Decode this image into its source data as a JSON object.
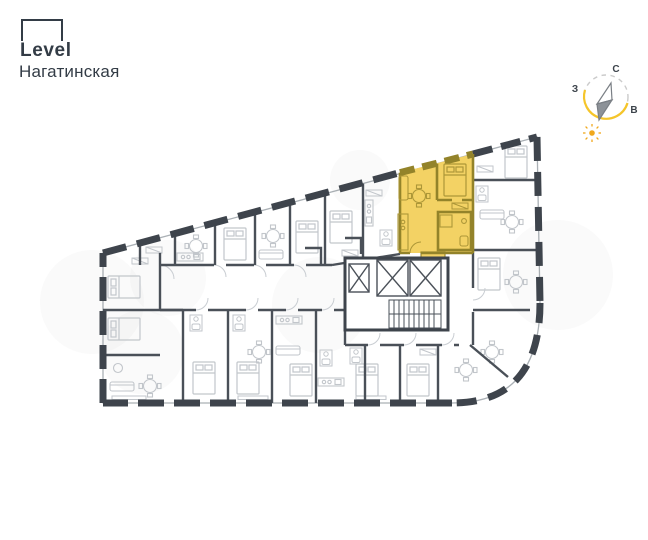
{
  "brand": {
    "logo_text": "Level",
    "project_name": "Нагатинская"
  },
  "compass": {
    "north_label": "С",
    "west_label": "З",
    "east_label": "В"
  },
  "icons": {
    "logo_square": "level-logo-square-icon",
    "compass": "compass-rose-icon",
    "needle": "compass-needle-icon",
    "sun": "sun-icon"
  },
  "colors": {
    "brand_navy": "#333C46",
    "wall_dark": "#3E444C",
    "wall_interior": "#4A5058",
    "furniture_gray": "#C2C6CB",
    "highlight_fill": "#F3D264",
    "highlight_wall": "#93832A",
    "highlight_furniture": "#AD9738",
    "compass_arc_gold": "#F5C52A",
    "sun_gold": "#F0A81C"
  }
}
